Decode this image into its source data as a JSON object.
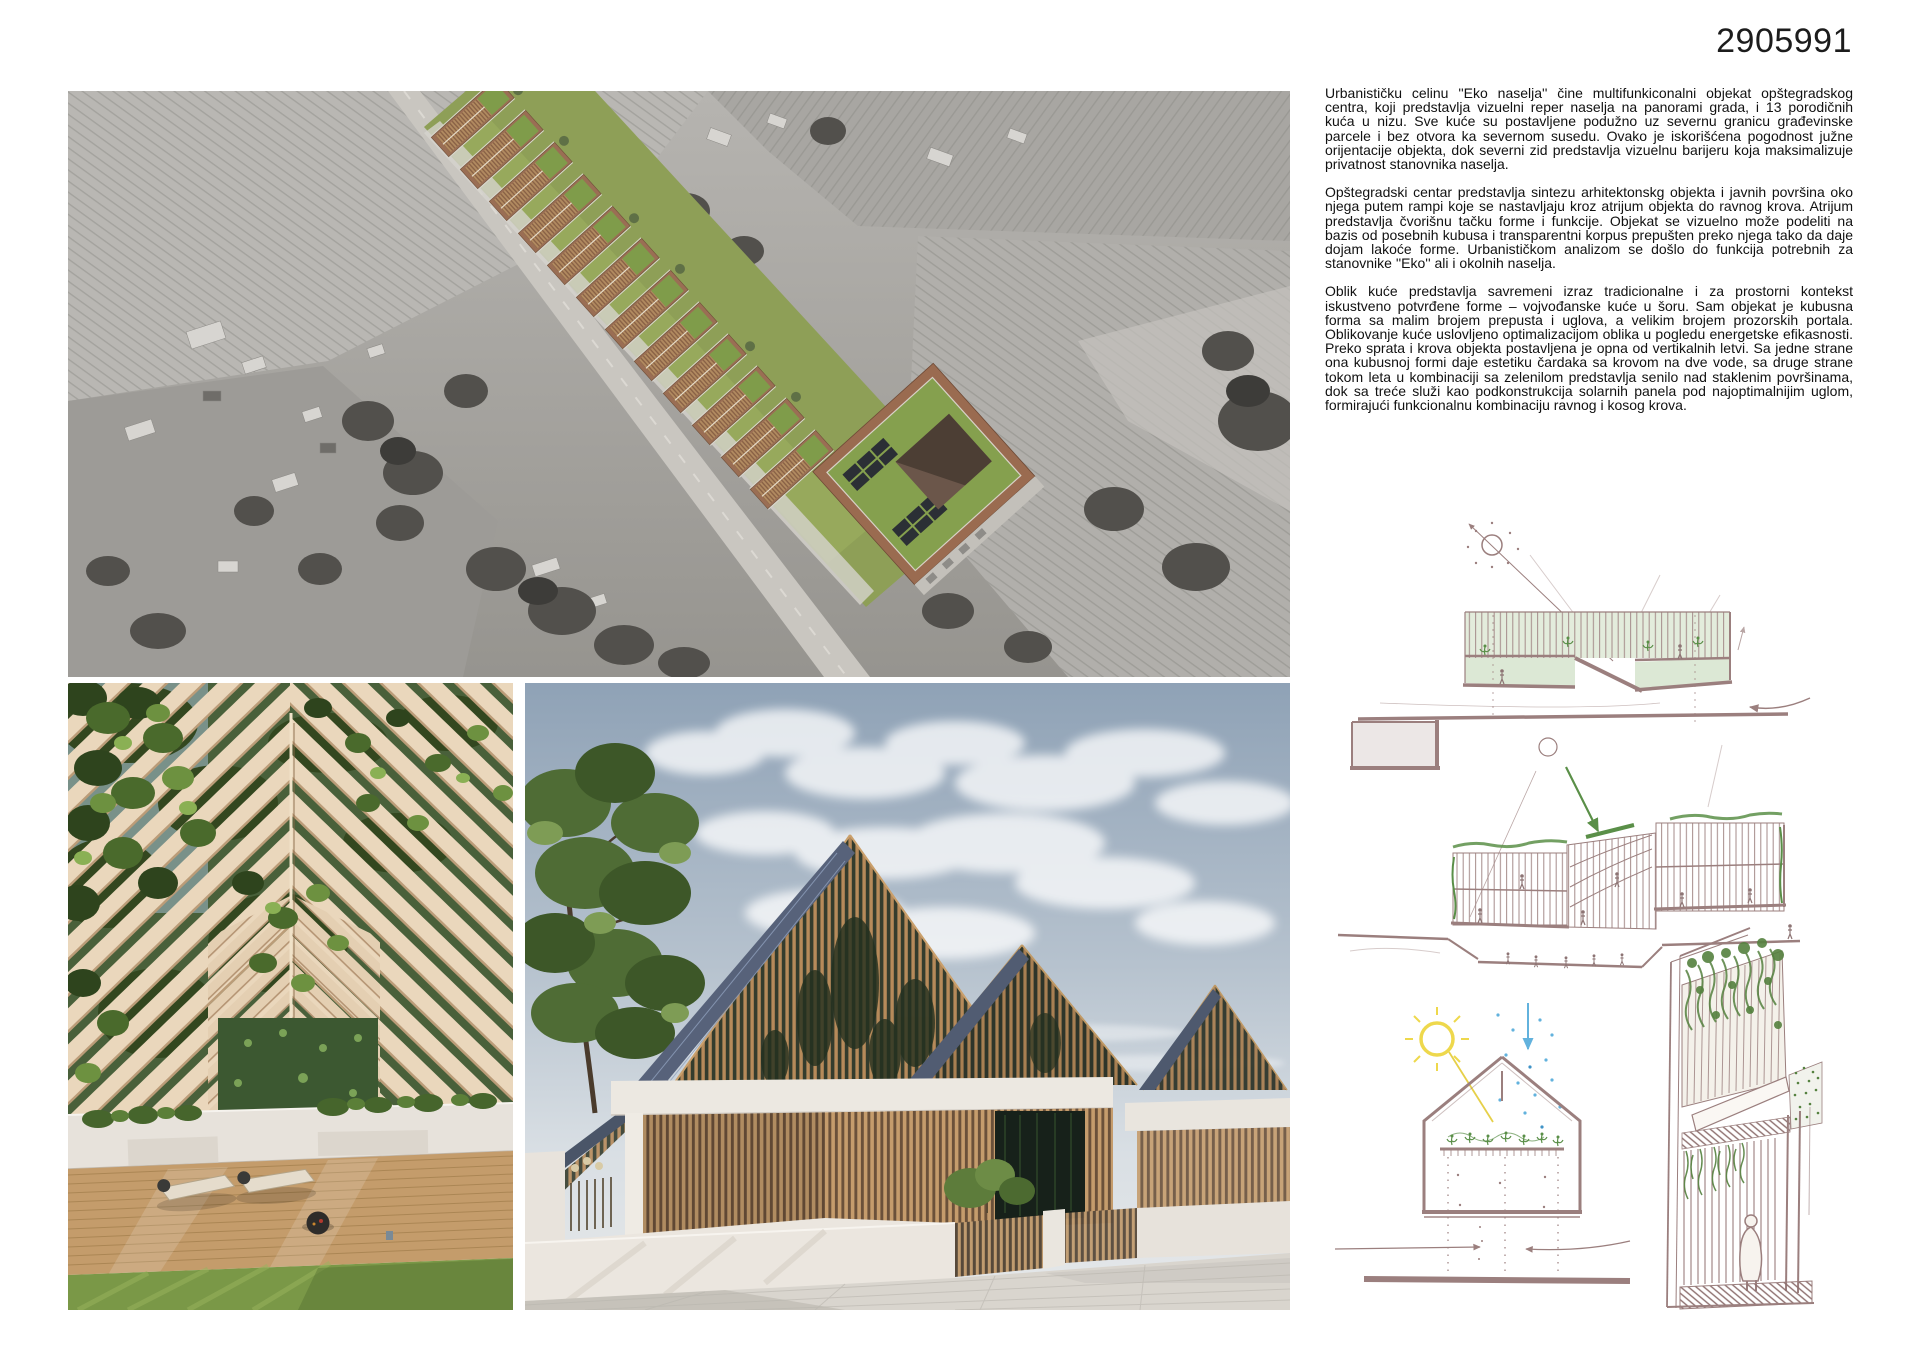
{
  "board": {
    "entry_number": "2905991"
  },
  "description": {
    "p1": "Urbanističku celinu ''Eko naselja'' čine multifunkiconalni objekat opštegradskog centra, koji predstavlja vizuelni reper naselja na panorami grada, i 13 porodičnih kuća u nizu. Sve kuće su postavljene podužno uz severnu granicu građevinske parcele i bez otvora ka severnom susedu. Ovako je iskorišćena pogodnost južne orijentacije objekta, dok severni zid predstavlja vizuelnu barijeru koja maksimalizuje privatnost stanovnika naselja.",
    "p2": "Opštegradski centar predstavlja sintezu arhitektonskg objekta i javnih površina oko njega putem rampi koje se nastavljaju kroz atrijum objekta do ravnog krova. Atrijum predstavlja čvorišnu tačku forme i funkcije. Objekat se vizuelno može podeliti na bazis od posebnih kubusa i transparentni korpus prepušten preko njega tako da daje dojam lakoće forme. Urbanističkom analizom se došlo do funkcija potrebnih za stanovnike ''Eko'' ali i okolnih naselja.",
    "p3": "Oblik kuće predstavlja savremeni izraz tradicionalne i za prostorni kontekst iskustveno potvrđene forme – vojvođanske kuće u šoru. Sam objekat je kubusna forma sa malim brojem prepusta i uglova, a velikim brojem prozorskih portala. Oblikovanje kuće uslovljeno optimalizacijom oblika u pogledu energetske efikasnosti. Preko sprata i krova objekta postavljena je opna od vertikalnih letvi. Sa jedne strane ona kubusnoj formi daje estetiku čardaka sa krovom na dve vode, sa druge strane tokom leta u kombinaciji sa zelenilom predstavlja senilo nad staklenim površinama, dok sa treće služi kao podkonstrukcija solarnih panela pod najoptimalnijim uglom, formirajući funkcionalnu kombinaciju ravnog i kosog krova."
  },
  "palette": {
    "sketch_line": "#9b7f7e",
    "sketch_green": "#5a8f48",
    "sketch_green_fill": "#e3ecdc",
    "sun_yellow": "#eed84c",
    "rain_blue": "#62b2dd",
    "timber": "#b68a5a",
    "lawn_green": "#8e9f57",
    "text_color": "#111111"
  }
}
